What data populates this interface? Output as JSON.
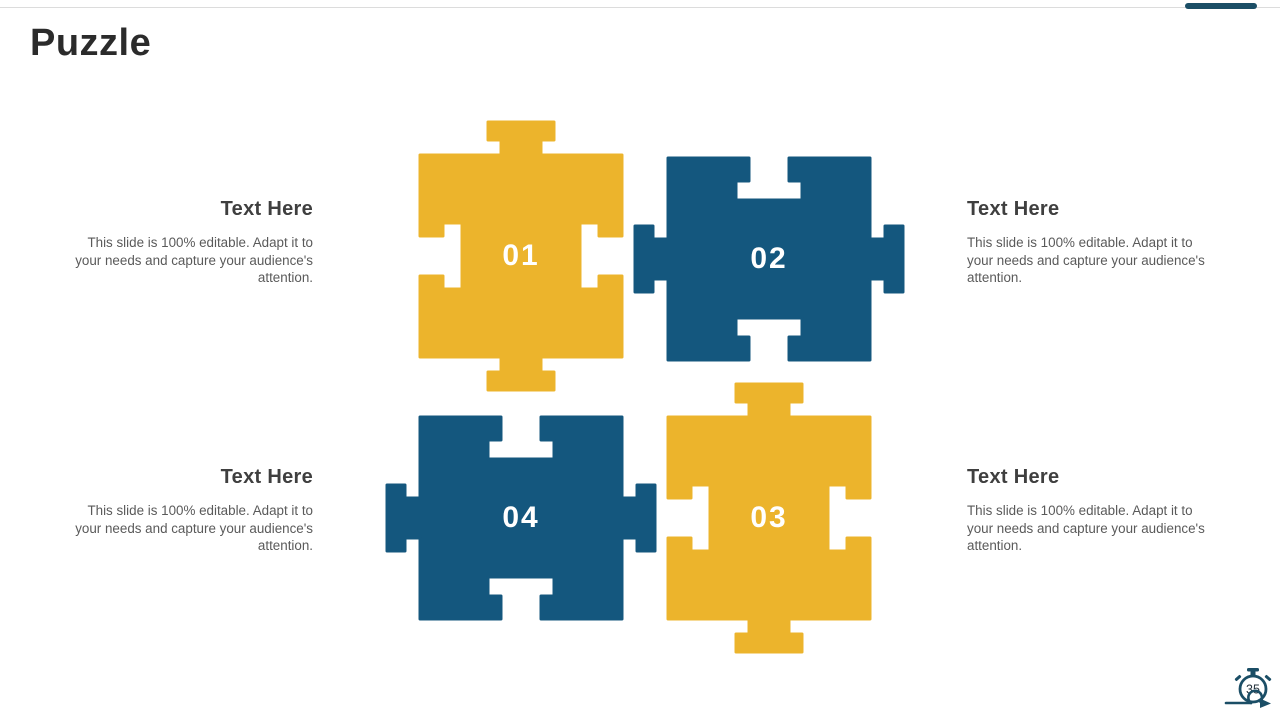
{
  "slide": {
    "title": "Puzzle",
    "page_number": "35"
  },
  "colors": {
    "yellow": "#ecb42c",
    "navy": "#14577e",
    "accent_bar": "#1b4e66",
    "heading_text": "#3f3f3f",
    "body_text": "#5a5a5a"
  },
  "pieces": [
    {
      "number": "01",
      "color": "#ecb42c"
    },
    {
      "number": "02",
      "color": "#14577e"
    },
    {
      "number": "03",
      "color": "#ecb42c"
    },
    {
      "number": "04",
      "color": "#14577e"
    }
  ],
  "text_blocks": [
    {
      "heading": "Text Here",
      "body": "This slide is 100% editable. Adapt it to your needs and capture your audience's attention."
    },
    {
      "heading": "Text Here",
      "body": "This slide is 100% editable. Adapt it to your needs and capture your audience's attention."
    },
    {
      "heading": "Text Here",
      "body": "This slide is 100% editable. Adapt it to your needs and capture your audience's attention."
    },
    {
      "heading": "Text Here",
      "body": "This slide is 100% editable. Adapt it to your needs and capture your audience's attention."
    }
  ]
}
